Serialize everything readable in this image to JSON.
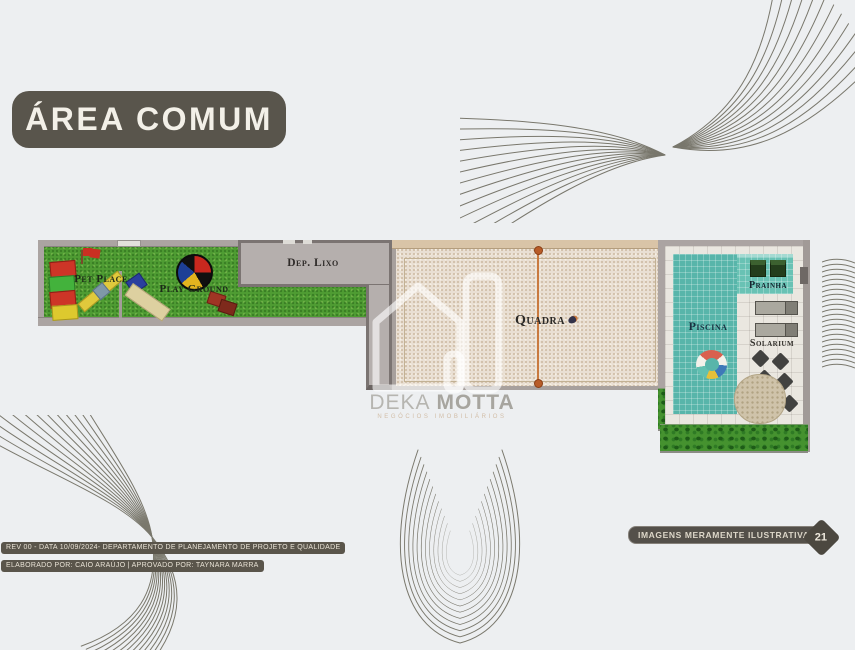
{
  "slide": {
    "title": "ÁREA COMUM",
    "footer": {
      "revision_line1": "REV 00 - DATA 10/09/2024- DEPARTAMENTO DE PLANEJAMENTO DE PROJETO E QUALIDADE",
      "revision_line2": "ELABORADO POR: CAIO ARAÚJO | APROVADO POR: TAYNARA MARRA",
      "disclaimer": "IMAGENS MERAMENTE ILUSTRATIVAS|",
      "page_number": "21"
    }
  },
  "watermark": {
    "brand_primary": "DEKA",
    "brand_secondary": "MOTTA",
    "tagline": "NEGÓCIOS IMOBILIÁRIOS"
  },
  "site_plan": {
    "areas": {
      "pet_place": "Pet Place",
      "play_ground": "Play Ground",
      "dep_lixo": "Dep. Lixo",
      "quadra": "Quadra",
      "piscina": "Piscina",
      "prainha": "Prainha",
      "solarium": "Solarium"
    }
  },
  "colors": {
    "background": "#edeff1",
    "title_pill": "#59554c",
    "swirl_line": "#5d5a4c",
    "grass": "#4f9c33",
    "sand": "#e9dfd3",
    "pool_teal": "#58b5aa",
    "net_orange": "#c97a3f",
    "footer_pill": "#54504a"
  }
}
